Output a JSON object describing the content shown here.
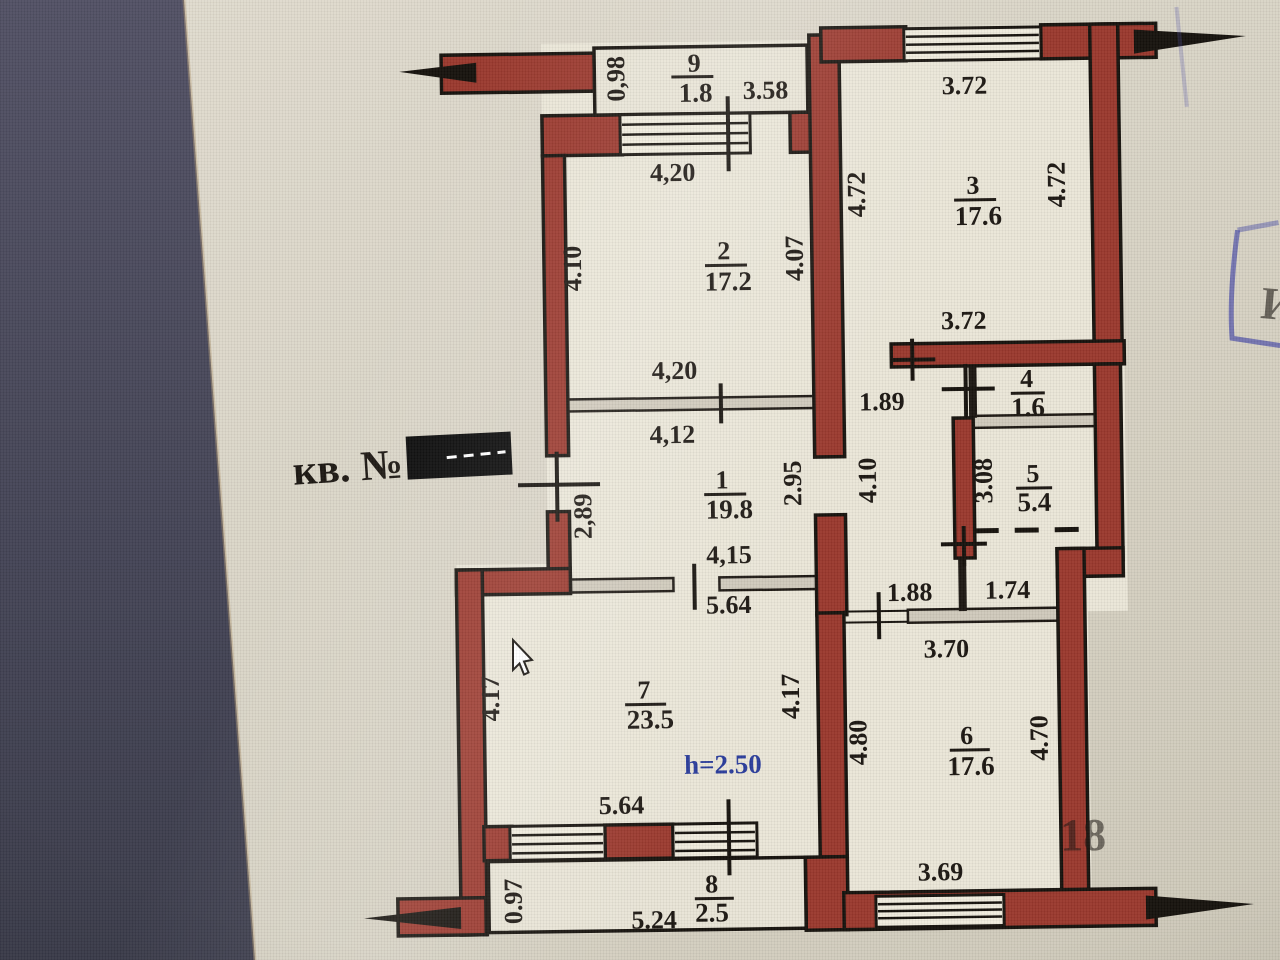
{
  "photo": {
    "apartment_label": "кв. №",
    "height_note": "h=2.50",
    "stamp_letter": "И",
    "watermark": "18"
  },
  "colors": {
    "wall": "#9a382d",
    "line": "#1c1712",
    "paper": "#dcd7c9",
    "room": "#eae6d8",
    "partition": "#cfc9bb",
    "band": "#4a4a5c",
    "blue_note": "#2a3c9b",
    "stamp": "#4a4da6",
    "redaction": "#0a0a0a",
    "label_red": "#7e241b"
  },
  "rooms": [
    {
      "num": "9",
      "area": "1.8"
    },
    {
      "num": "2",
      "area": "17.2"
    },
    {
      "num": "3",
      "area": "17.6"
    },
    {
      "num": "1",
      "area": "19.8"
    },
    {
      "num": "4",
      "area": "1.6"
    },
    {
      "num": "5",
      "area": "5.4"
    },
    {
      "num": "7",
      "area": "23.5"
    },
    {
      "num": "6",
      "area": "17.6"
    },
    {
      "num": "8",
      "area": "2.5"
    }
  ],
  "dims": [
    "0,98",
    "3.58",
    "4,20",
    "3.72",
    "4.72",
    "4.72",
    "4.10",
    "4.07",
    "4,20",
    "3.72",
    "4,12",
    "1.89",
    "2.95",
    "4.10",
    "2,89",
    "3.08",
    "4,15",
    "5.64",
    "1.88",
    "1.74",
    "3.70",
    "4.17",
    "4.17",
    "4.80",
    "4.70",
    "5.64",
    "0.97",
    "5.24",
    "3.69"
  ]
}
